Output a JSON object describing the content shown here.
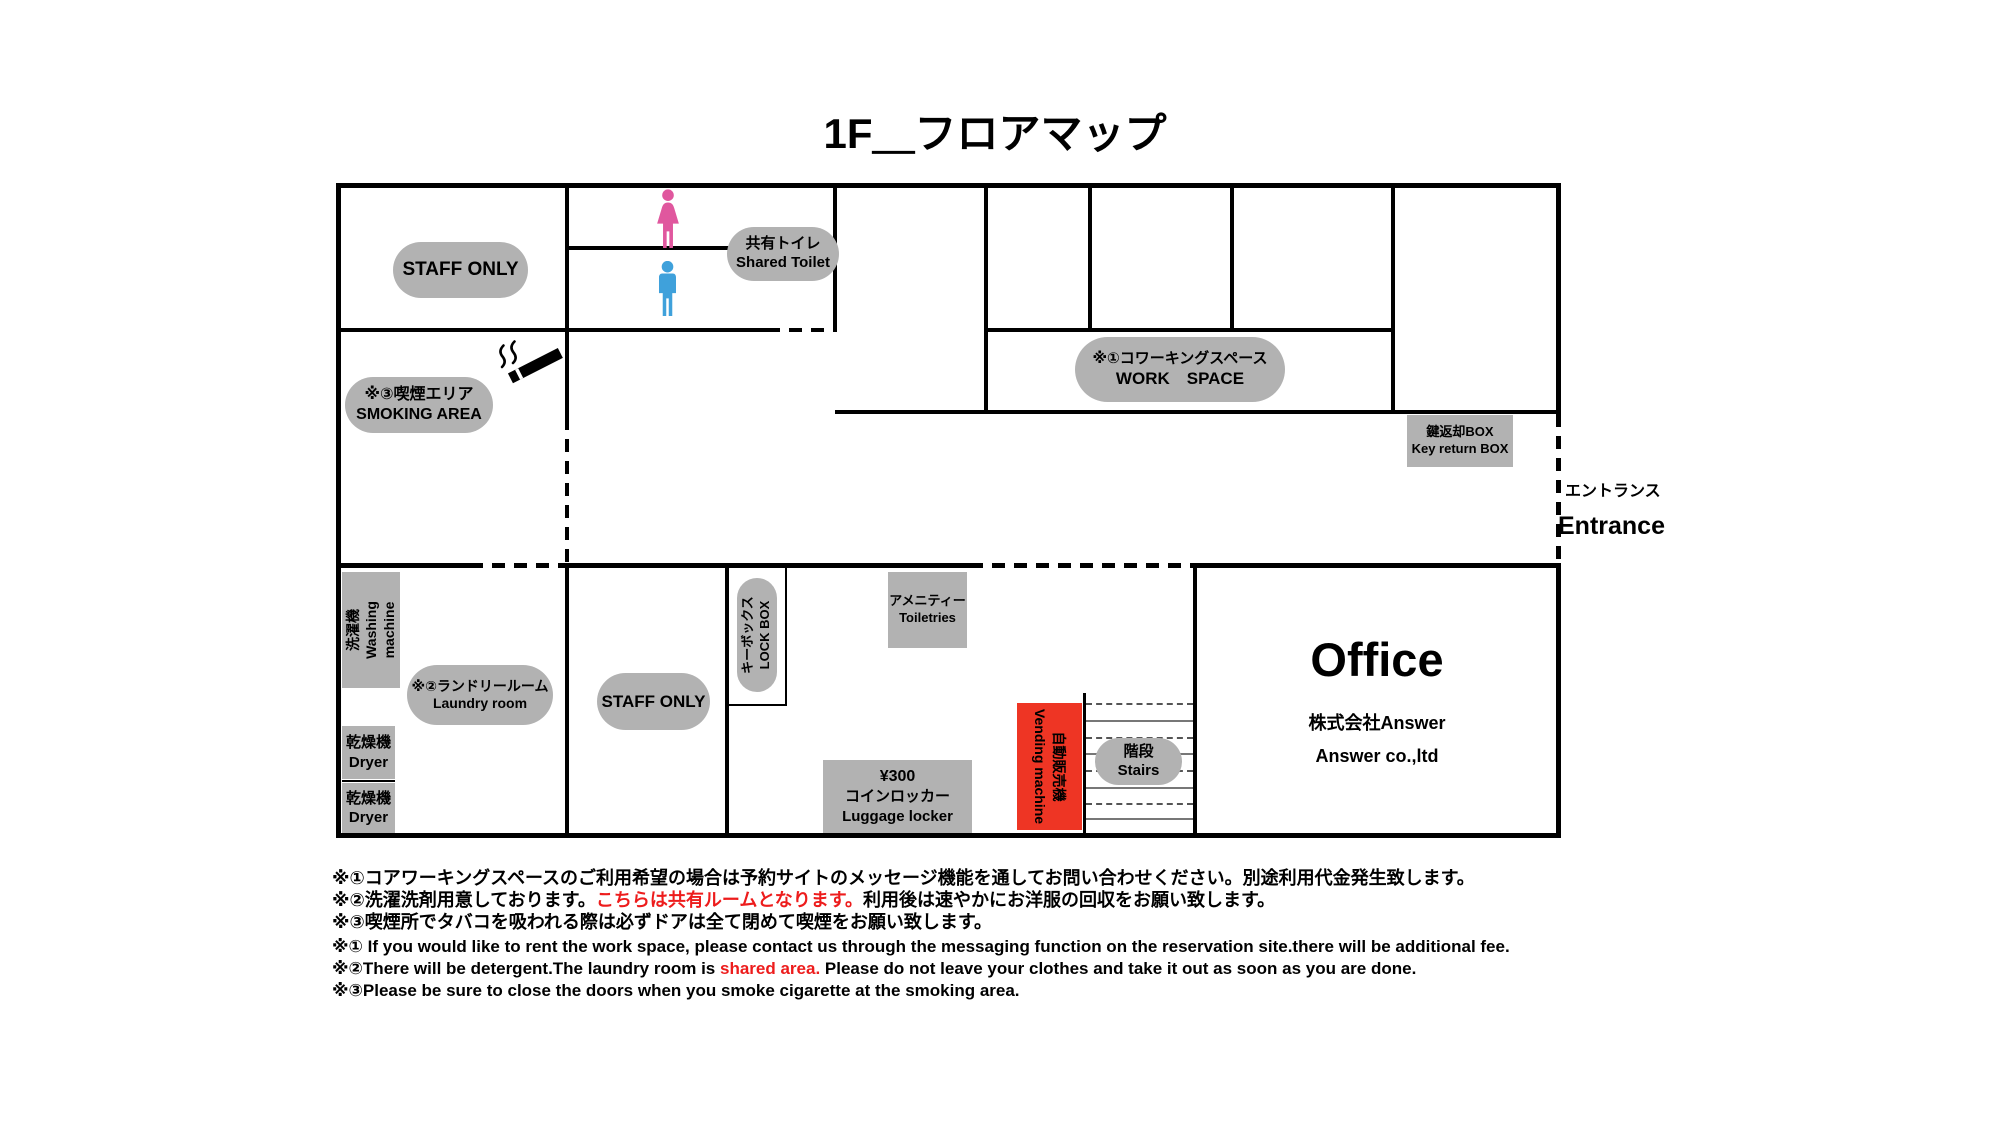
{
  "title": "1F＿フロアマップ",
  "colors": {
    "gray": "#b2b2b2",
    "vending_red": "#ee3524",
    "female_pink": "#e0579e",
    "male_blue": "#3fa1db",
    "note_red": "#ed1c1c"
  },
  "rooms": {
    "staff_only_upper": {
      "label": "STAFF ONLY"
    },
    "shared_toilet": {
      "jp": "共有トイレ",
      "en": "Shared Toilet"
    },
    "smoking_area": {
      "jp": "※③喫煙エリア",
      "en": "SMOKING AREA"
    },
    "coworking": {
      "jp": "※①コワーキングスペース",
      "en": "WORK　SPACE"
    },
    "key_return_box": {
      "jp": "鍵返却BOX",
      "en": "Key return BOX"
    },
    "entrance": {
      "jp": "エントランス",
      "en": "Entrance"
    },
    "washing_machine": {
      "jp": "洗濯機",
      "en": "Washing machine"
    },
    "laundry_room": {
      "jp": "※②ランドリールーム",
      "en": "Laundry room"
    },
    "dryer_1": {
      "jp": "乾燥機",
      "en": "Dryer"
    },
    "dryer_2": {
      "jp": "乾燥機",
      "en": "Dryer"
    },
    "staff_only_lower": {
      "label": "STAFF ONLY"
    },
    "lock_box": {
      "jp": "キーボックス",
      "en": "LOCK BOX"
    },
    "toiletries": {
      "jp": "アメニティー",
      "en": "Toiletries"
    },
    "luggage_locker": {
      "price": "¥300",
      "jp": "コインロッカー",
      "en": "Luggage locker"
    },
    "vending_machine": {
      "jp": "自動販売機",
      "en": "Vending machine"
    },
    "stairs": {
      "jp": "階段",
      "en": "Stairs"
    },
    "office": {
      "title": "Office",
      "company_jp": "株式会社Answer",
      "company_en": "Answer co.,ltd"
    }
  },
  "notes_jp": [
    {
      "pre": "※①コアワーキングスペースのご利用希望の場合は予約サイトのメッセージ機能を通してお問い合わせください。別途利用代金発生致します。",
      "red": "",
      "post": ""
    },
    {
      "pre": "※②洗濯洗剤用意しております。",
      "red": "こちらは共有ルームとなります。",
      "post": "利用後は速やかにお洋服の回収をお願い致します。"
    },
    {
      "pre": "※③喫煙所でタバコを吸われる際は必ずドアは全て閉めて喫煙をお願い致します。",
      "red": "",
      "post": ""
    }
  ],
  "notes_en": [
    {
      "pre": "※① If you would like to rent the work space, please contact us through the messaging function on the reservation site.there will be additional fee.",
      "red": "",
      "post": ""
    },
    {
      "pre": "※②There will be detergent.The laundry room is ",
      "red": "shared area.",
      "post": " Please do not leave your clothes and take it out as soon as you are done."
    },
    {
      "pre": "※③Please be sure to close the doors when you smoke cigarette at the smoking area.",
      "red": "",
      "post": ""
    }
  ]
}
